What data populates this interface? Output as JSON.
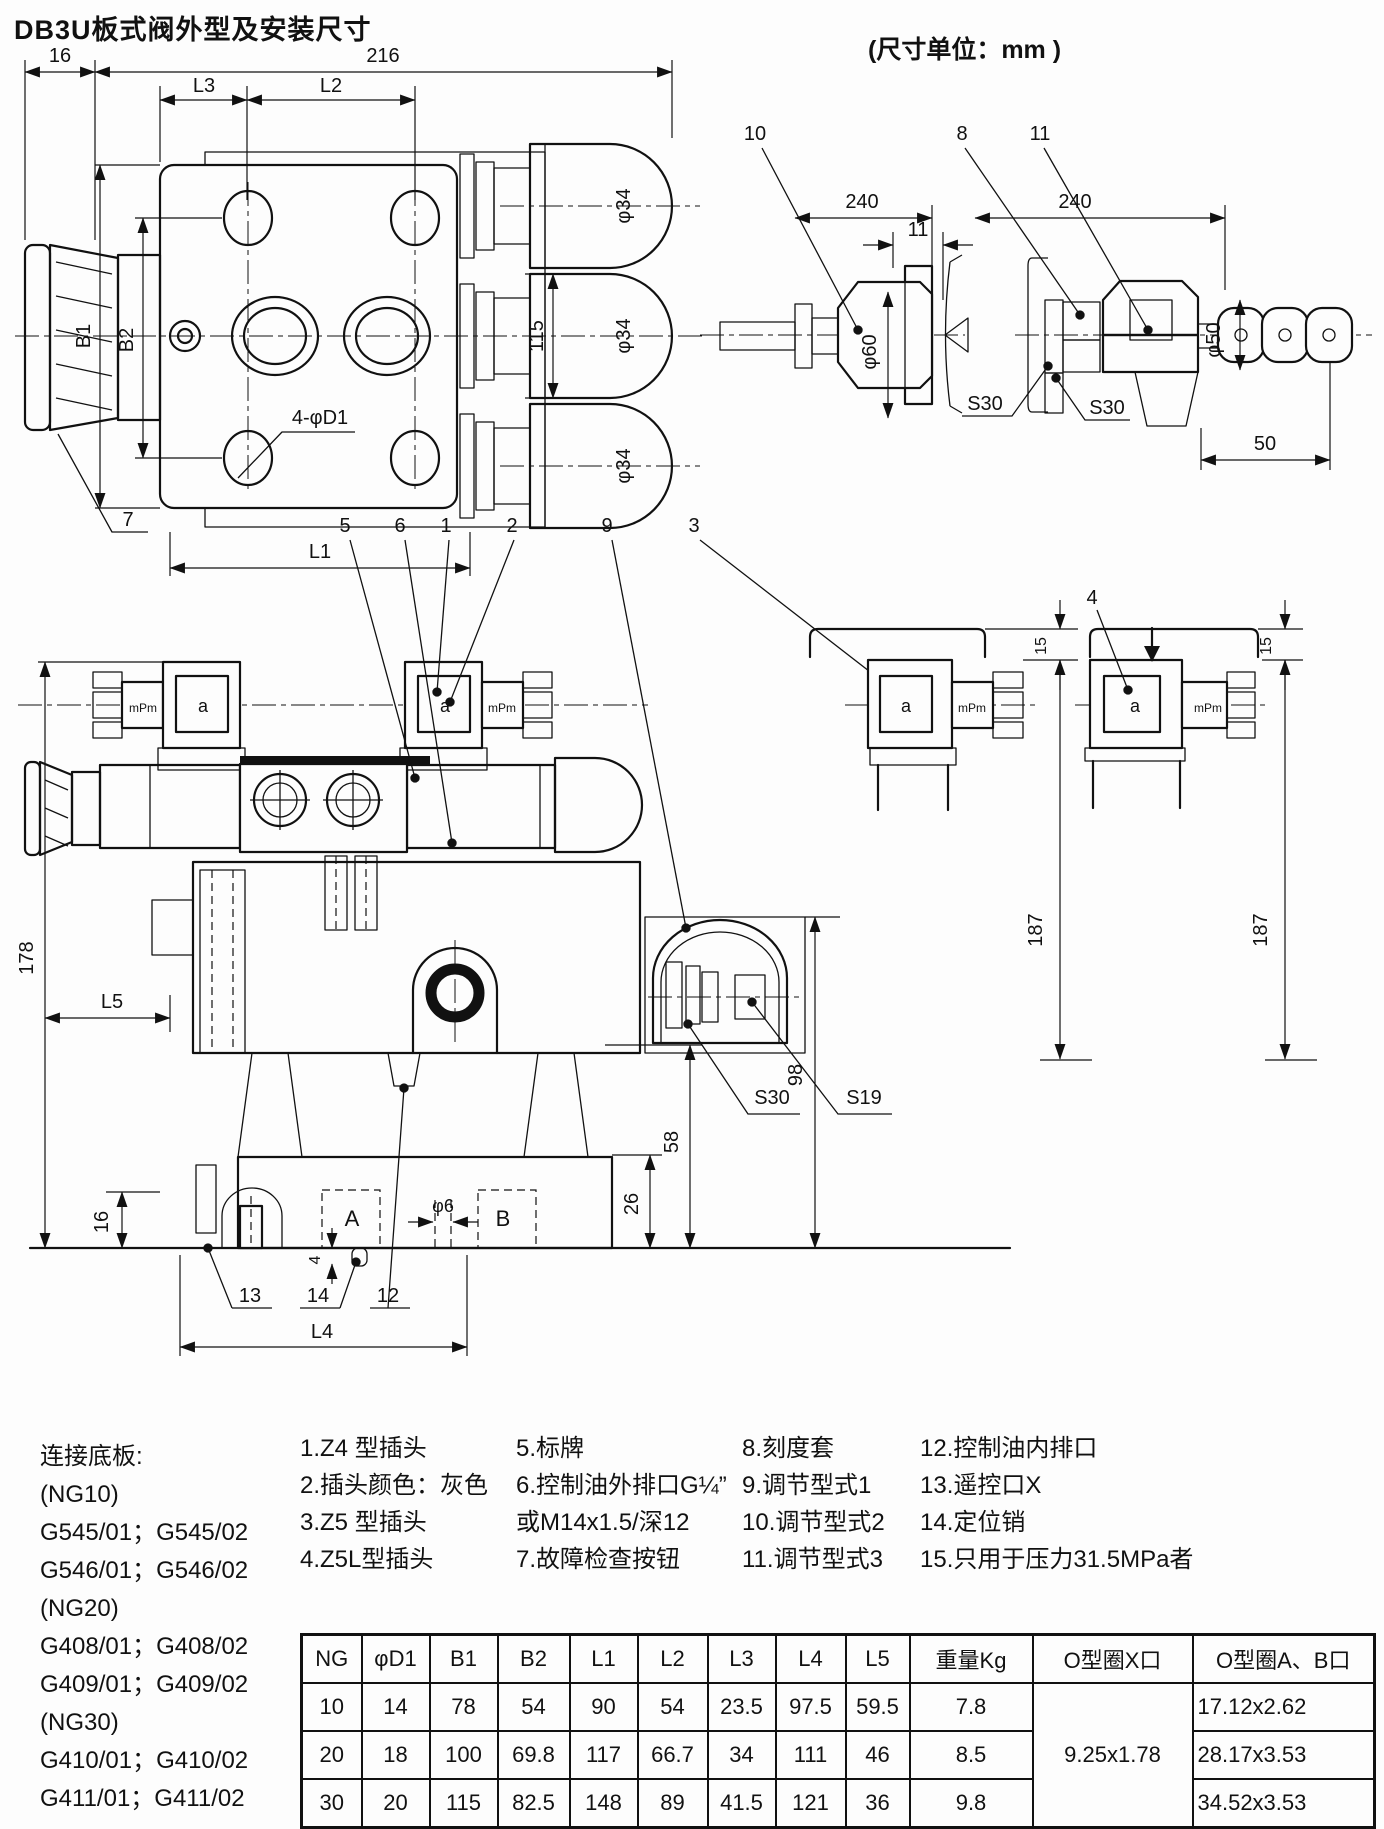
{
  "title": "DB3U板式阀外型及安装尺寸",
  "unit_note": "(尺寸单位：mm )",
  "top_view": {
    "w16": "16",
    "w216": "216",
    "L3": "L3",
    "L2": "L2",
    "B1": "B1",
    "B2": "B2",
    "h115": "115",
    "phi34": "φ34",
    "holes": "4-φD1",
    "L1": "L1",
    "c7": "7"
  },
  "adjust_view": {
    "c10": "10",
    "c8": "8",
    "c11": "11",
    "d240": "240",
    "d11": "11",
    "phi60": "φ60",
    "phi50": "φ50",
    "s30": "S30",
    "d50": "50"
  },
  "side_view": {
    "c1": "1",
    "c2": "2",
    "c3": "3",
    "c4": "4",
    "c5": "5",
    "c6": "6",
    "c9": "9",
    "c12": "12",
    "c13": "13",
    "c14": "14",
    "a": "a",
    "mpm": "mPm",
    "d178": "178",
    "L5": "L5",
    "d16": "16",
    "A": "A",
    "B": "B",
    "phi6": "φ6",
    "d4": "4",
    "d26": "26",
    "d58": "58",
    "d98": "98",
    "s30": "S30",
    "s19": "S19",
    "L4": "L4",
    "d15": "15",
    "d187": "187"
  },
  "legend": {
    "baseplate": [
      "连接底板:",
      "(NG10)",
      "G545/01；G545/02",
      "G546/01；G546/02",
      "(NG20)",
      "G408/01；G408/02",
      "G409/01；G409/02",
      "(NG30)",
      "G410/01；G410/02",
      "G411/01；G411/02"
    ],
    "col1": [
      "1.Z4 型插头",
      "2.插头颜色：灰色",
      "3.Z5 型插头",
      "4.Z5L型插头"
    ],
    "col2": [
      "5.标牌",
      "6.控制油外排口G¼”",
      "或M14x1.5/深12",
      "7.故障检查按钮"
    ],
    "col3": [
      "8.刻度套",
      "9.调节型式1",
      "10.调节型式2",
      "11.调节型式3"
    ],
    "col4": [
      "12.控制油内排口",
      "13.遥控口X",
      "14.定位销",
      "15.只用于压力31.5MPa者"
    ]
  },
  "table": {
    "headers": [
      "NG",
      "φD1",
      "B1",
      "B2",
      "L1",
      "L2",
      "L3",
      "L4",
      "L5",
      "重量Kg",
      "O型圈X口",
      "O型圈A、B口"
    ],
    "oring_x_merged": "9.25x1.78",
    "rows": [
      [
        "10",
        "14",
        "78",
        "54",
        "90",
        "54",
        "23.5",
        "97.5",
        "59.5",
        "7.8",
        "17.12x2.62"
      ],
      [
        "20",
        "18",
        "100",
        "69.8",
        "117",
        "66.7",
        "34",
        "111",
        "46",
        "8.5",
        "28.17x3.53"
      ],
      [
        "30",
        "20",
        "115",
        "82.5",
        "148",
        "89",
        "41.5",
        "121",
        "36",
        "9.8",
        "34.52x3.53"
      ]
    ]
  }
}
